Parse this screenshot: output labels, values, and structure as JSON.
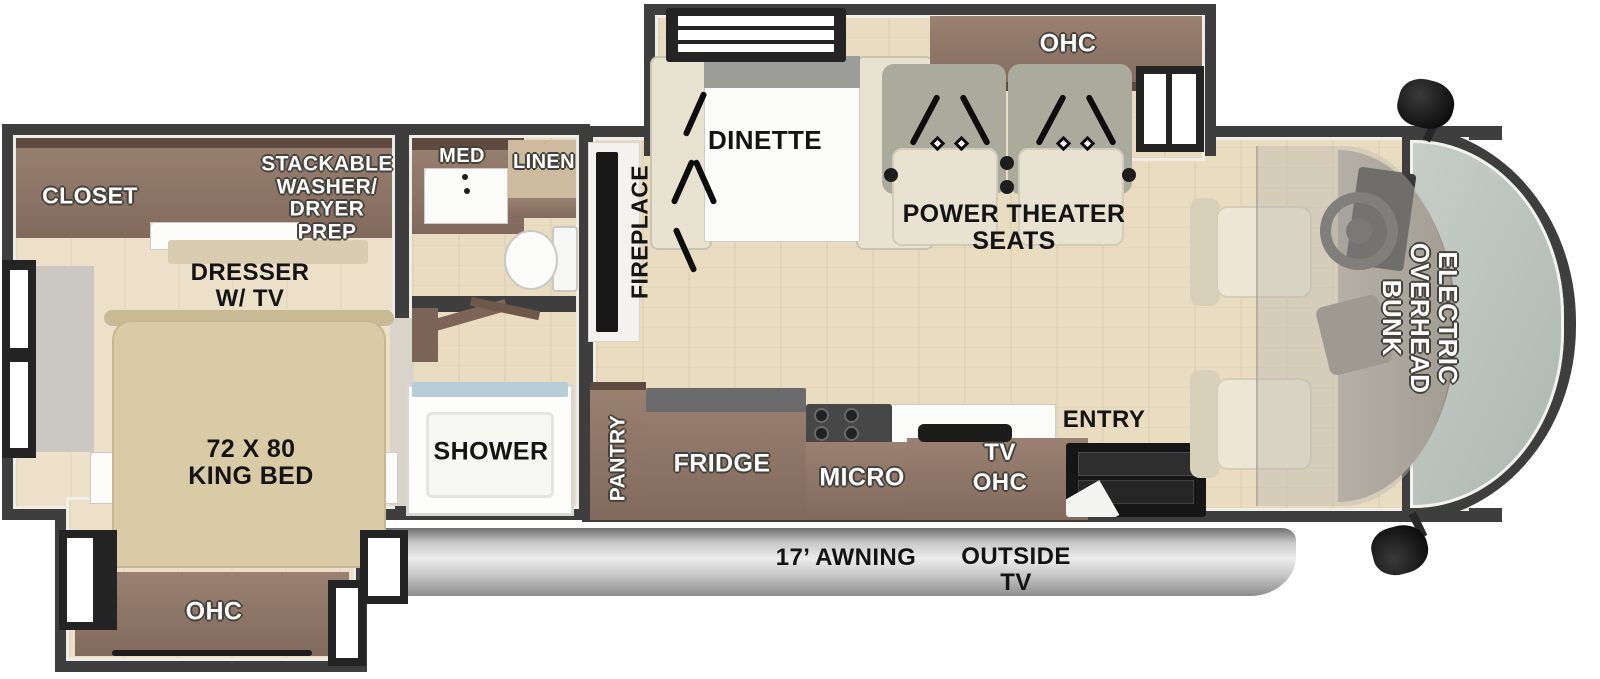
{
  "title": "RV floor plan with electric overhead bunk",
  "colors": {
    "wall": "#3e3e3e",
    "floor": "#e9dcc0",
    "cabinet_brown": "#8a7164",
    "cabinet_trim": "#5e4a3f",
    "bed_beige": "#d9cba6",
    "seat_beige": "#e8e3d1",
    "seat_back": "#abab9d",
    "windshield_glass": "#b9c2bb",
    "awning_silver": "#c9c9c9",
    "label_white": "#ffffff",
    "label_black": "#141414"
  },
  "labels": {
    "closet": "CLOSET",
    "washer_prep": {
      "l1": "STACKABLE",
      "l2": "WASHER/",
      "l3": "DRYER",
      "l4": "PREP"
    },
    "dresser": {
      "l1": "DRESSER",
      "l2": "W/ TV"
    },
    "king_bed": {
      "l1": "72 X 80",
      "l2": "KING BED"
    },
    "bedroom_ohc": "OHC",
    "med": "MED",
    "linen": "LINEN",
    "shower": "SHOWER",
    "fireplace": "FIREPLACE",
    "dinette": "DINETTE",
    "living_ohc": "OHC",
    "theater": {
      "l1": "POWER THEATER",
      "l2": "SEATS"
    },
    "pantry": "PANTRY",
    "fridge": "FRIDGE",
    "micro": "MICRO",
    "tv_ohc": {
      "l1": "TV",
      "l2": "OHC"
    },
    "entry": "ENTRY",
    "bunk": {
      "l1": "ELECTRIC",
      "l2": "OVERHEAD",
      "l3": "BUNK"
    },
    "awning": "17’ AWNING",
    "outside_tv": {
      "l1": "OUTSIDE",
      "l2": "TV"
    }
  }
}
